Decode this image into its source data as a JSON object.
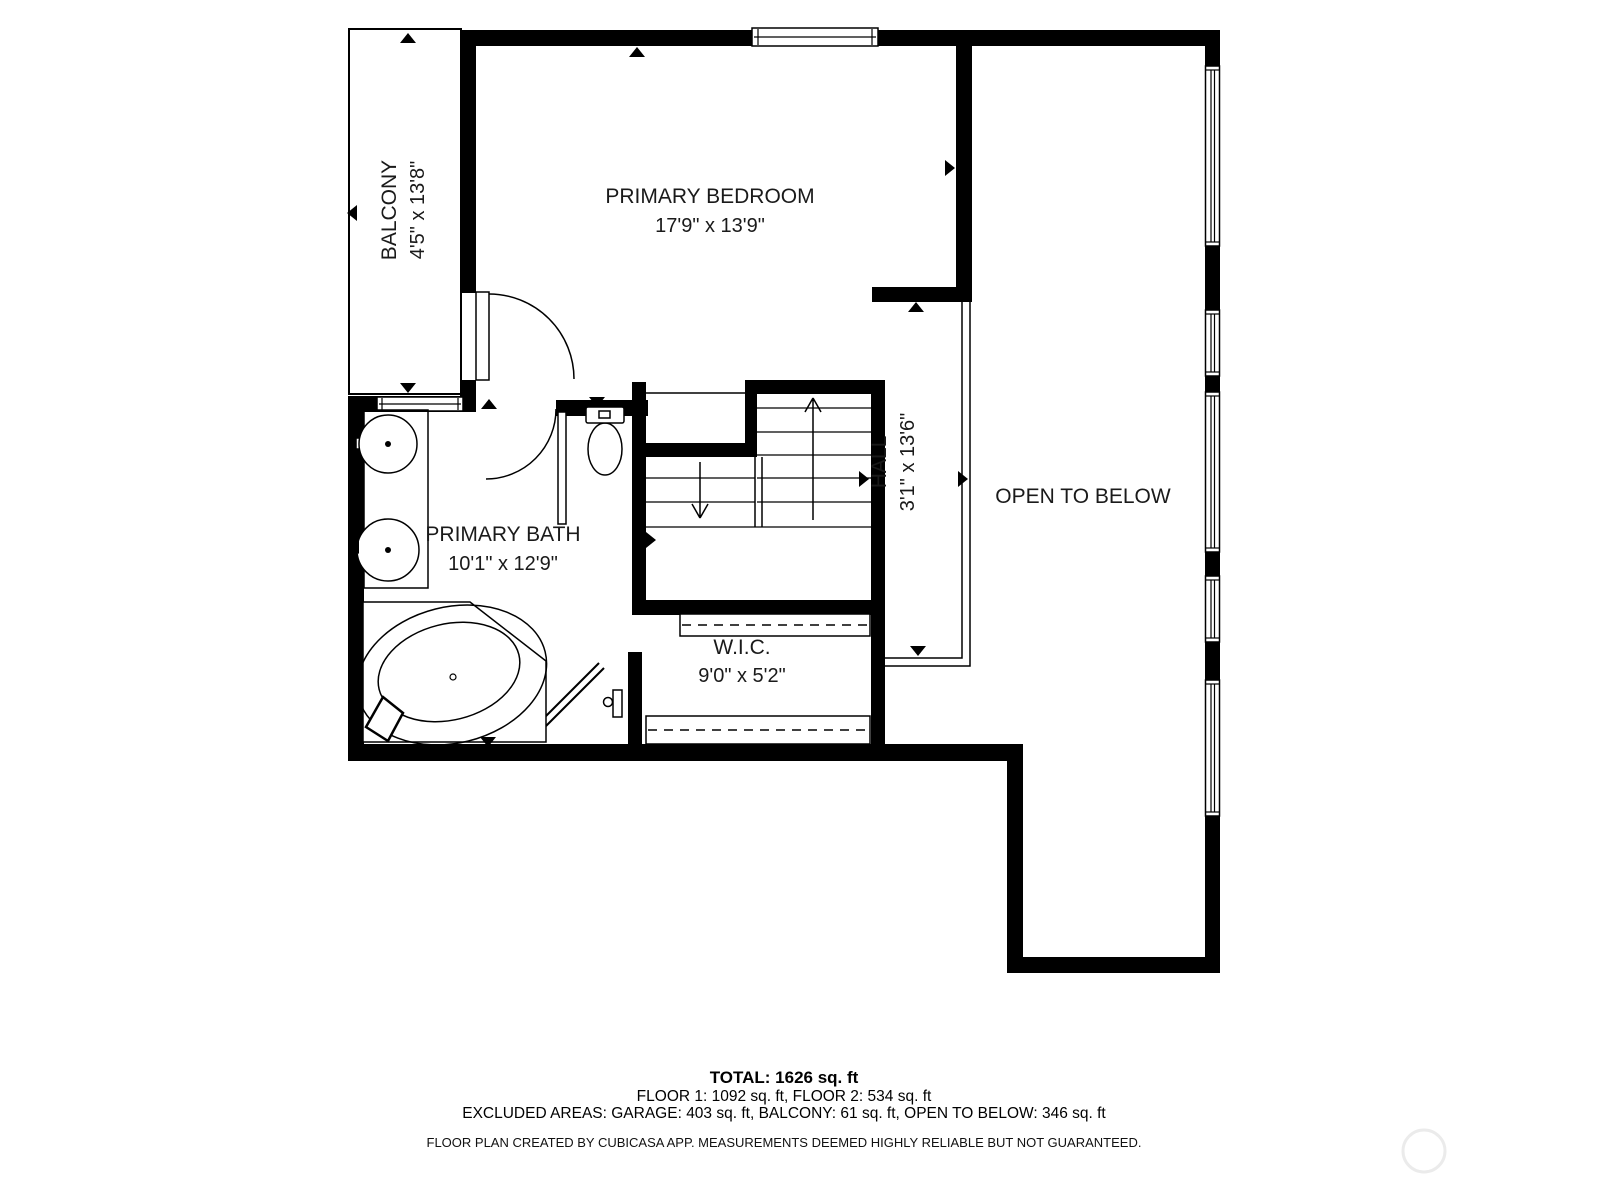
{
  "plan": {
    "rooms": [
      {
        "id": "balcony",
        "label": "BALCONY",
        "dims": "4'5\" x 13'8\""
      },
      {
        "id": "primary_bedroom",
        "label": "PRIMARY BEDROOM",
        "dims": "17'9\" x 13'9\""
      },
      {
        "id": "primary_bath",
        "label": "PRIMARY BATH",
        "dims": "10'1\" x 12'9\""
      },
      {
        "id": "hall",
        "label": "HALL",
        "dims": "3'1\" x 13'6\""
      },
      {
        "id": "wic",
        "label": "W.I.C.",
        "dims": "9'0\" x 5'2\""
      },
      {
        "id": "open_to_below",
        "label": "OPEN TO BELOW",
        "dims": ""
      }
    ],
    "summary": {
      "total": "TOTAL: 1626 sq. ft",
      "floors": "FLOOR 1: 1092 sq. ft, FLOOR 2: 534 sq. ft",
      "excluded": "EXCLUDED AREAS: GARAGE: 403 sq. ft, BALCONY: 61 sq. ft, OPEN TO BELOW: 346 sq. ft",
      "disclaimer": "FLOOR PLAN CREATED BY CUBICASA APP. MEASUREMENTS DEEMED HIGHLY RELIABLE BUT NOT GUARANTEED."
    },
    "colors": {
      "wall": "#000000",
      "background": "#ffffff",
      "watermark": "#ebebeb"
    }
  }
}
